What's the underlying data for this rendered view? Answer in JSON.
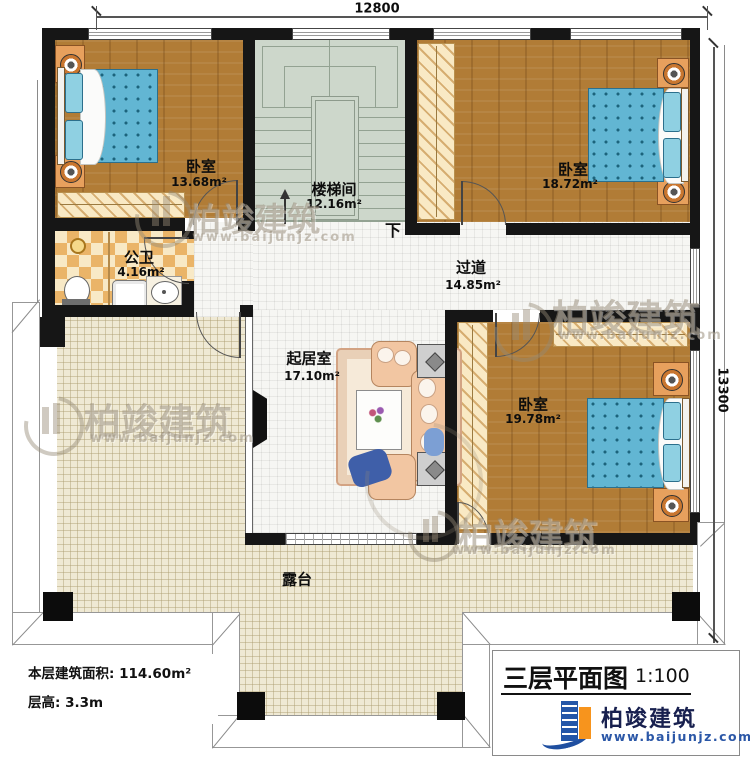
{
  "dimensions": {
    "top_width": "12800",
    "right_height": "13300"
  },
  "rooms": {
    "bedroom_tl": {
      "name": "卧室",
      "area": "13.68m²"
    },
    "stairwell": {
      "name": "楼梯间",
      "area": "12.16m²"
    },
    "bedroom_tr": {
      "name": "卧室",
      "area": "18.72m²"
    },
    "bathroom": {
      "name": "公卫",
      "area": "4.16m²"
    },
    "hallway": {
      "name": "过道",
      "area": "14.85m²"
    },
    "living": {
      "name": "起居室",
      "area": "17.10m²"
    },
    "bedroom_br": {
      "name": "卧室",
      "area": "19.78m²"
    },
    "terrace": {
      "name": "露台"
    }
  },
  "stairs": {
    "down_label": "下"
  },
  "info": {
    "area_label": "本层建筑面积:",
    "area_value": "114.60m²",
    "height_label": "层高:",
    "height_value": "3.3m"
  },
  "title_block": {
    "title": "三层平面图",
    "scale": "1:100",
    "brand": "柏竣建筑",
    "website": "www.baijunjz.com"
  },
  "watermark": {
    "brand": "柏竣建筑",
    "website": "www.baijunjz.com"
  },
  "colors": {
    "wall": "#161616",
    "wood": "#b17c36",
    "tile": "#f6f6f3",
    "terrace": "#efe9d4",
    "stair": "#cdd7cb",
    "bath_tile": "#eab468",
    "bed": "#62b6d3",
    "brand_blue": "#2456a8",
    "brand_orange": "#f7941d",
    "url_blue": "#2b57a7"
  }
}
